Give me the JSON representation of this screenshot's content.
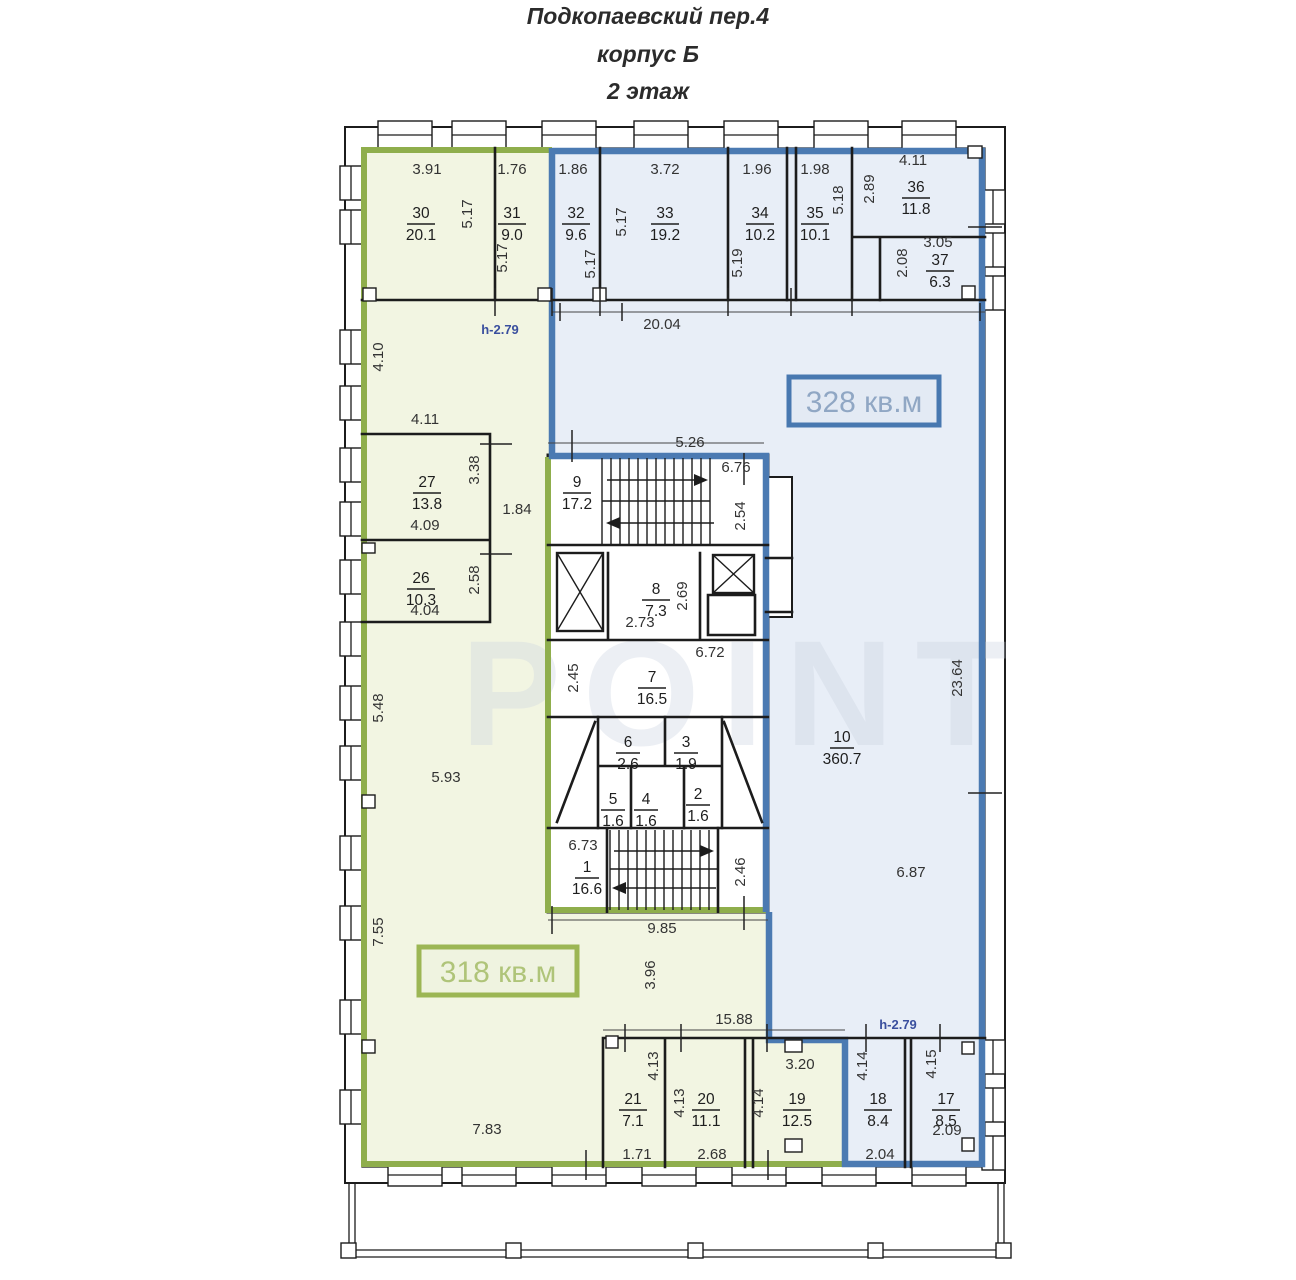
{
  "title": {
    "line1": "Подкопаевский пер.4",
    "line2": "корпус Б",
    "line3": "2 этаж"
  },
  "area_labels": {
    "blue": "328 кв.м",
    "green": "318 кв.м"
  },
  "height_note_top": "h-2.79",
  "height_note_bottom": "h-2.79",
  "watermark": "POINT",
  "colors": {
    "green_border": "#8FAE4C",
    "green_fill": "#F2F5E2",
    "blue_border": "#4B7AB2",
    "blue_fill": "#E8EEF7"
  },
  "rooms": {
    "r30": {
      "num": "30",
      "area": "20.1"
    },
    "r31": {
      "num": "31",
      "area": "9.0"
    },
    "r32": {
      "num": "32",
      "area": "9.6"
    },
    "r33": {
      "num": "33",
      "area": "19.2"
    },
    "r34": {
      "num": "34",
      "area": "10.2"
    },
    "r35": {
      "num": "35",
      "area": "10.1"
    },
    "r36": {
      "num": "36",
      "area": "11.8"
    },
    "r37": {
      "num": "37",
      "area": "6.3"
    },
    "r27": {
      "num": "27",
      "area": "13.8"
    },
    "r26": {
      "num": "26",
      "area": "10.3"
    },
    "r10": {
      "num": "10",
      "area": "360.7"
    },
    "r9": {
      "num": "9",
      "area": "17.2"
    },
    "r8": {
      "num": "8",
      "area": "7.3"
    },
    "r7": {
      "num": "7",
      "area": "16.5"
    },
    "r6": {
      "num": "6",
      "area": "2.6"
    },
    "r5": {
      "num": "5",
      "area": "1.6"
    },
    "r4": {
      "num": "4",
      "area": "1.6"
    },
    "r3": {
      "num": "3",
      "area": "1.9"
    },
    "r2": {
      "num": "2",
      "area": "1.6"
    },
    "r1": {
      "num": "1",
      "area": "16.6"
    },
    "r21": {
      "num": "21",
      "area": "7.1"
    },
    "r20": {
      "num": "20",
      "area": "11.1"
    },
    "r19": {
      "num": "19",
      "area": "12.5"
    },
    "r18": {
      "num": "18",
      "area": "8.4"
    },
    "r17": {
      "num": "17",
      "area": "8.5"
    }
  },
  "dims": {
    "d391": "3.91",
    "d176": "1.76",
    "d186": "1.86",
    "d372": "3.72",
    "d196": "1.96",
    "d198": "1.98",
    "d411a": "4.11",
    "d305": "3.05",
    "d2004": "20.04",
    "d411b": "4.11",
    "d409": "4.09",
    "d184": "1.84",
    "d404": "4.04",
    "d526": "5.26",
    "d676": "6.76",
    "d273": "2.73",
    "d672": "6.72",
    "d673": "6.73",
    "d985": "9.85",
    "d593": "5.93",
    "d1588": "15.88",
    "d783": "7.83",
    "d171": "1.71",
    "d268": "2.68",
    "d320": "3.20",
    "d204": "2.04",
    "d209": "2.09",
    "d687": "6.87",
    "v517a": "5.17",
    "v517b": "5.17",
    "v517c": "5.17",
    "v517d": "5.17",
    "v519": "5.19",
    "v518": "5.18",
    "v289": "2.89",
    "v208": "2.08",
    "v410": "4.10",
    "v338": "3.38",
    "v258": "2.58",
    "v548": "5.48",
    "v755": "7.55",
    "v254": "2.54",
    "v269": "2.69",
    "v245": "2.45",
    "v2364": "23.64",
    "v246": "2.46",
    "v396": "3.96",
    "v413a": "4.13",
    "v413b": "4.13",
    "v414a": "4.14",
    "v414b": "4.14",
    "v415": "4.15"
  }
}
